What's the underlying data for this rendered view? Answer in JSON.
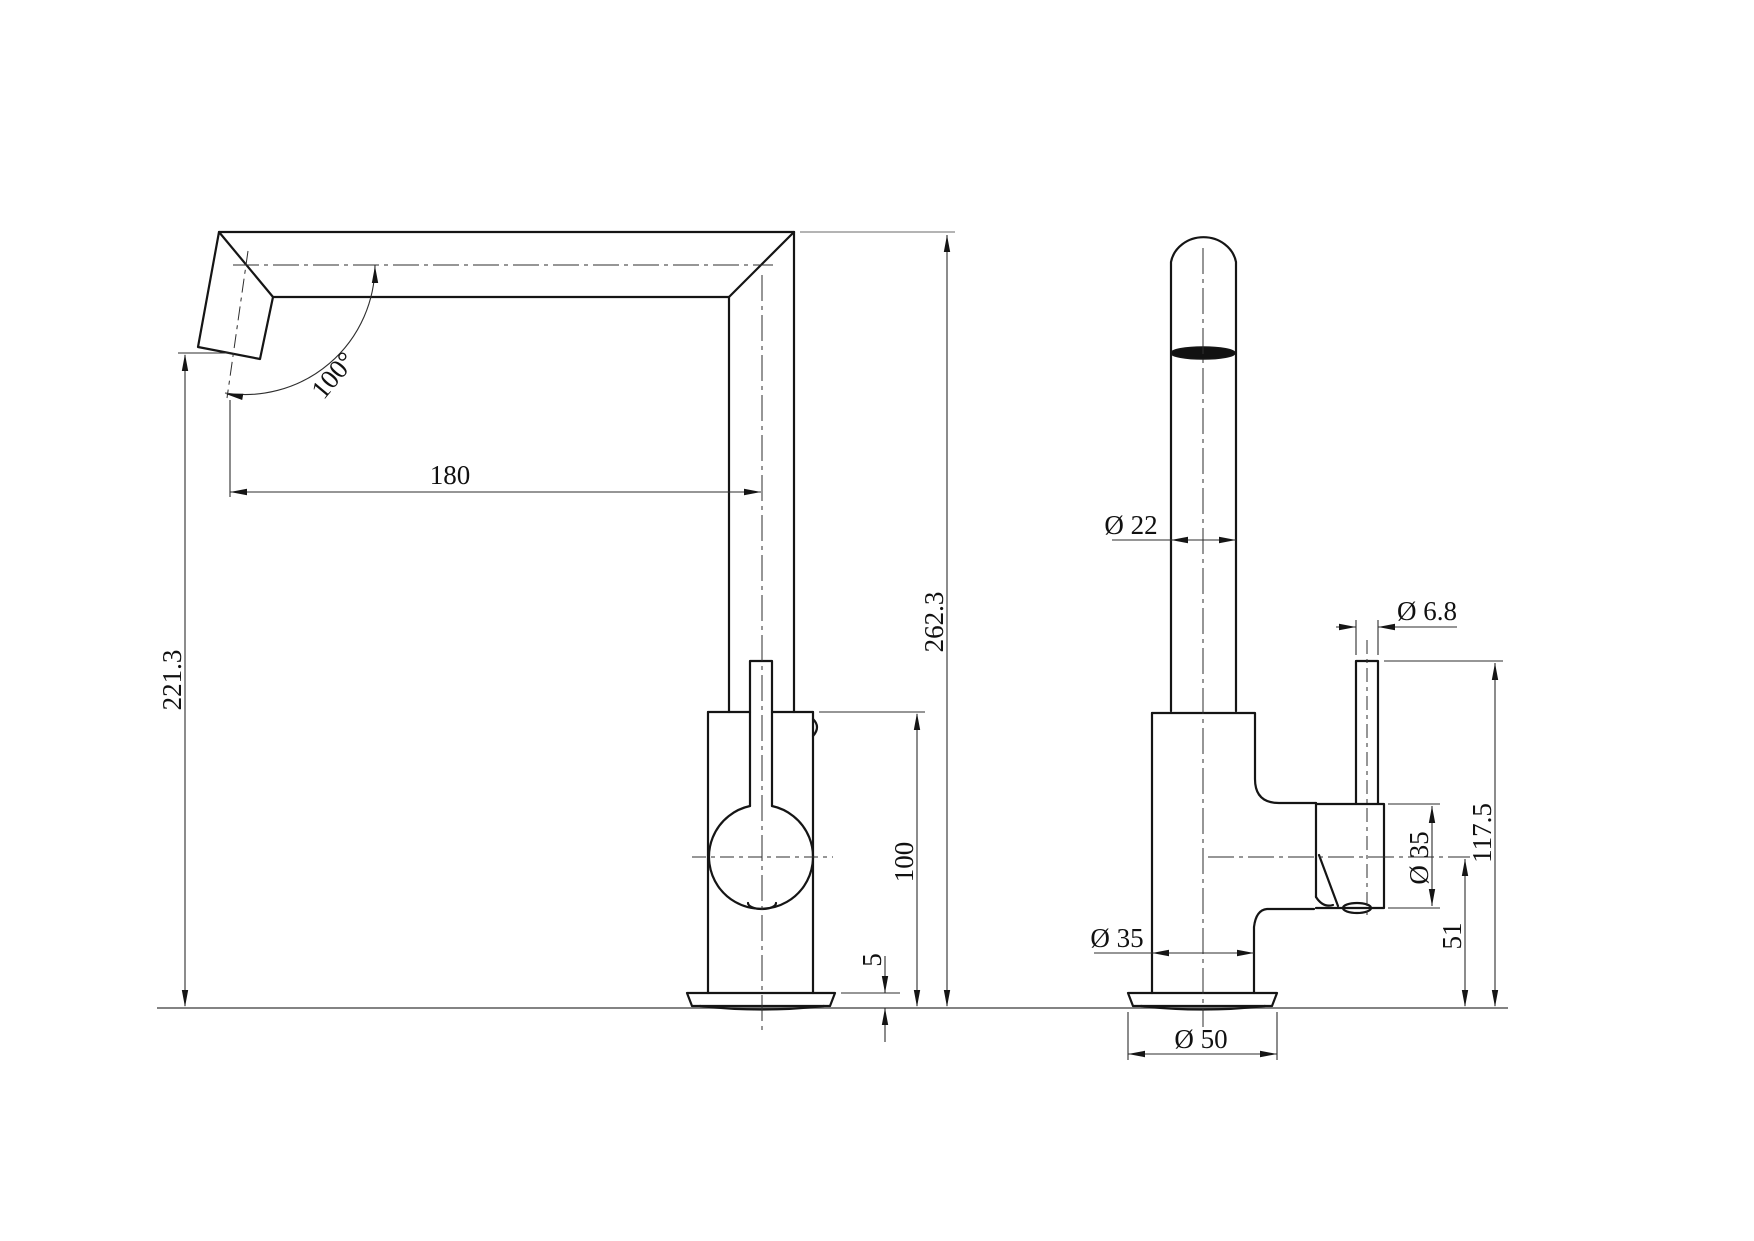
{
  "colors": {
    "background": "#ffffff",
    "object_line": "#151515",
    "dimension_line": "#2e2e2e"
  },
  "dims": {
    "front": {
      "spout_reach": "180",
      "spout_angle": "100°",
      "outlet_height": "221.3",
      "overall_height": "262.3",
      "body_height": "100",
      "base_thickness": "5"
    },
    "side": {
      "spout_diameter": "Ø 22",
      "rod_diameter": "Ø 6.8",
      "boss_diameter": "Ø 35",
      "body_diameter": "Ø 35",
      "base_diameter": "Ø 50",
      "handle_height": "117.5",
      "axis_height": "51"
    }
  }
}
